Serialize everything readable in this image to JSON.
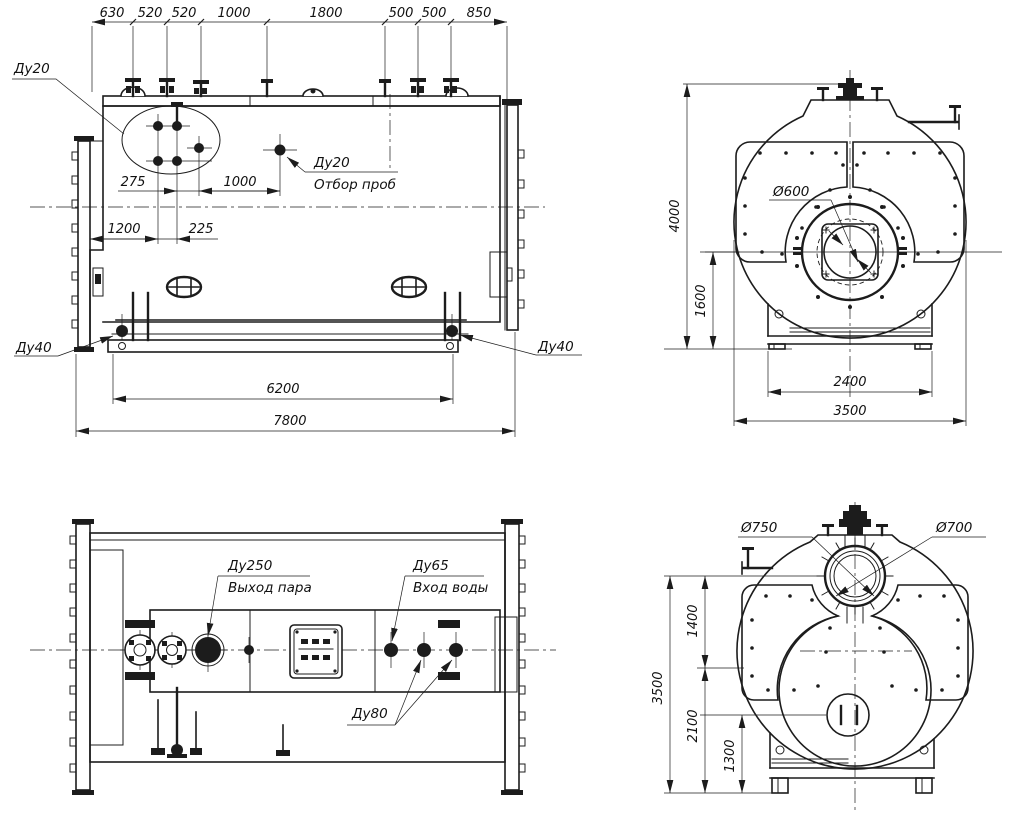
{
  "drawing": {
    "title": "Boiler general arrangement drawing",
    "views": {
      "side": {
        "chain": [
          "630",
          "520",
          "520",
          "1000",
          "1800",
          "500",
          "500",
          "850"
        ],
        "dim_275": "275",
        "dim_1000": "1000",
        "dim_1200": "1200",
        "dim_225": "225",
        "dim_6200": "6200",
        "dim_7800": "7800",
        "du20": "Ду20",
        "sample_line1": "Ду20",
        "sample_line2": "Отбор проб",
        "du40_left": "Ду40",
        "du40_right": "Ду40"
      },
      "front": {
        "dim_4000": "4000",
        "dim_1600": "1600",
        "dim_2400": "2400",
        "dim_3500": "3500",
        "d600": "Ø600"
      },
      "plan": {
        "du250_line1": "Ду250",
        "du250_line2": "Выход пара",
        "du65_line1": "Ду65",
        "du65_line2": "Вход воды",
        "du80": "Ду80"
      },
      "rear": {
        "dim_3500": "3500",
        "dim_2100": "2100",
        "dim_1300": "1300",
        "dim_1400": "1400",
        "d750": "Ø750",
        "d700": "Ø700"
      }
    }
  }
}
